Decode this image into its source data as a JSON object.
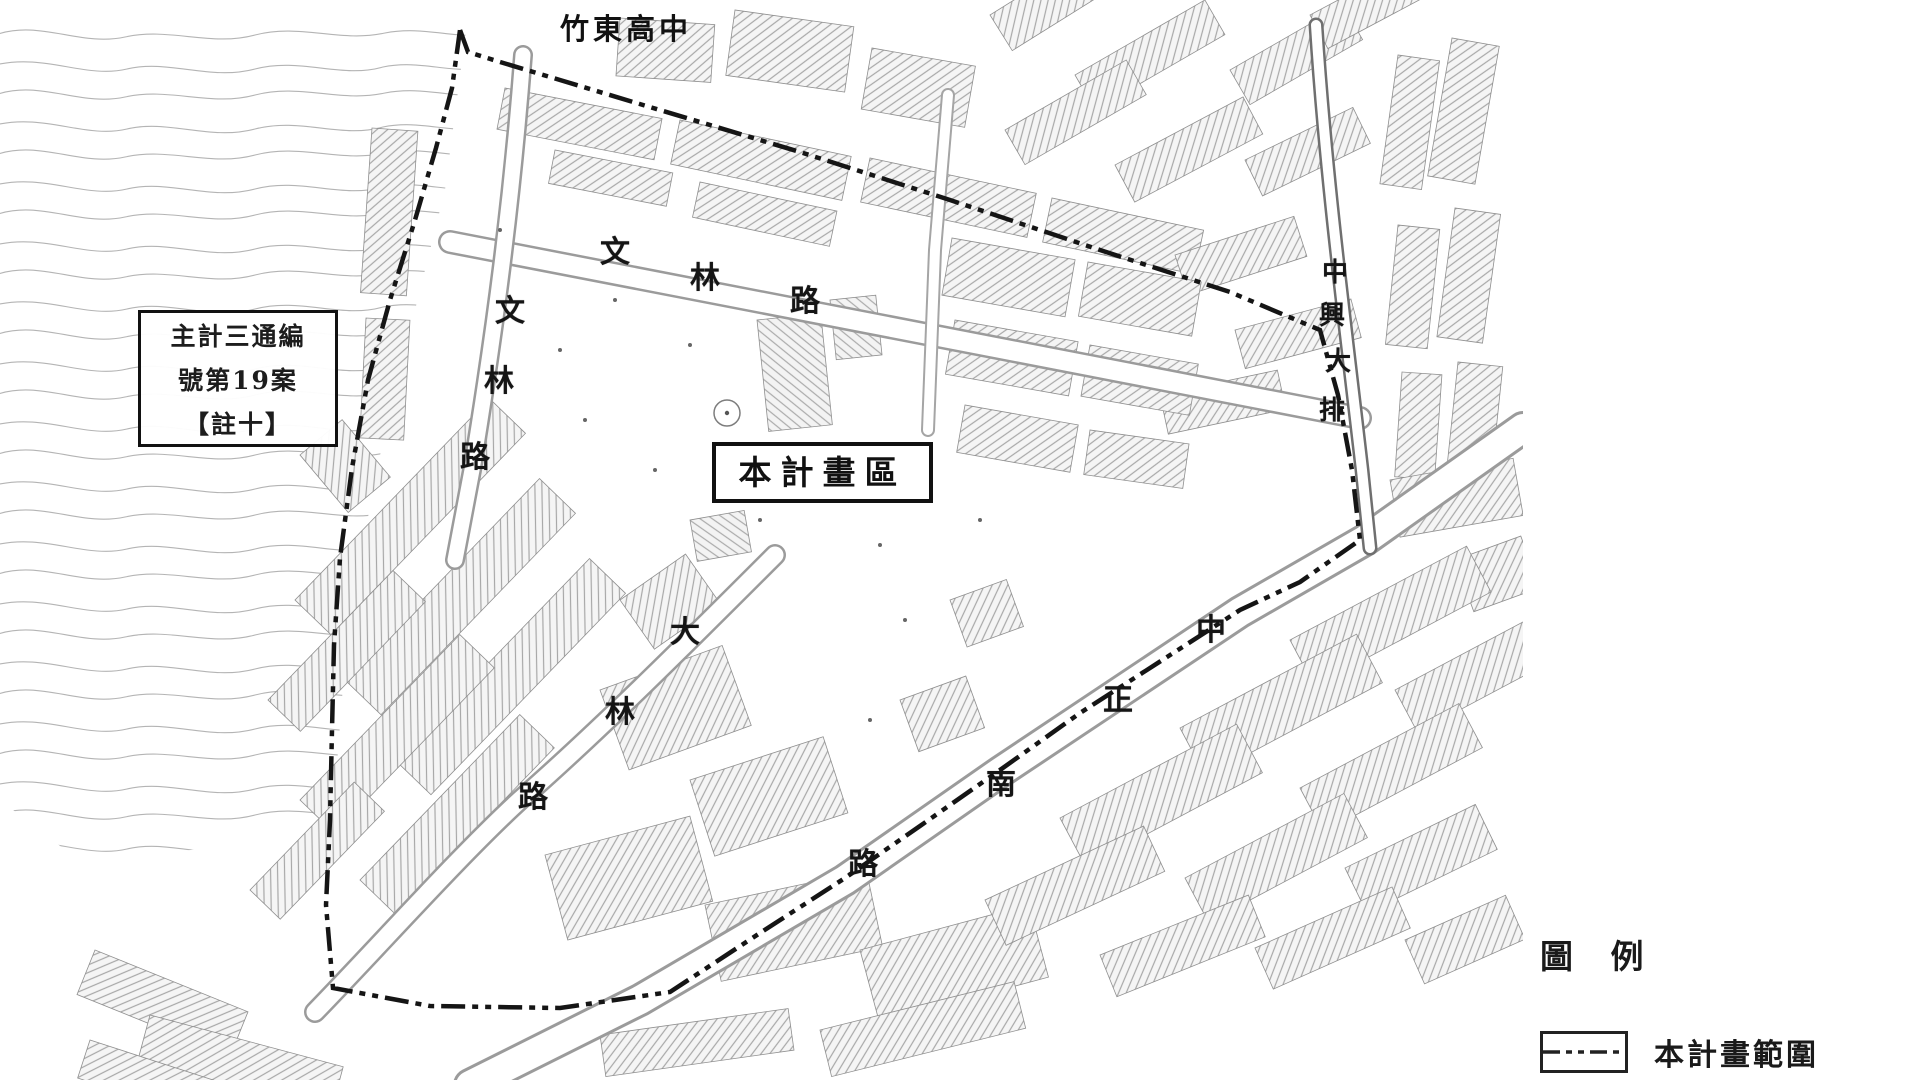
{
  "map": {
    "school_label": "竹東高中",
    "plan_area_box": "本計畫區",
    "case_note_box": {
      "line1": "主計三通編",
      "line2": "號第19案",
      "line3": "【註十】"
    },
    "roads": {
      "wenlin_top": {
        "name": "文林路",
        "chars": [
          "文",
          "林",
          "路"
        ]
      },
      "wenlin_left": {
        "name": "文林路",
        "chars": [
          "文",
          "林",
          "路"
        ]
      },
      "dalin": {
        "name": "大林路",
        "chars": [
          "大",
          "林",
          "路"
        ]
      },
      "zhongzheng_south": {
        "name": "中正南路",
        "chars": [
          "中",
          "正",
          "南",
          "路"
        ]
      },
      "zhongxing_drain": {
        "name": "中興大排",
        "chars": [
          "中",
          "興",
          "大",
          "排"
        ]
      }
    }
  },
  "legend": {
    "title": "圖 例",
    "items": [
      {
        "symbol": "plan-boundary-dashed-line",
        "label": "本計畫範圍"
      }
    ]
  },
  "colors": {
    "ink": "#151515",
    "boundary": "#151515",
    "contour": "#b4b4b4",
    "road_edge": "#9b9b9b",
    "hatch_line": "#a8a8a8"
  }
}
